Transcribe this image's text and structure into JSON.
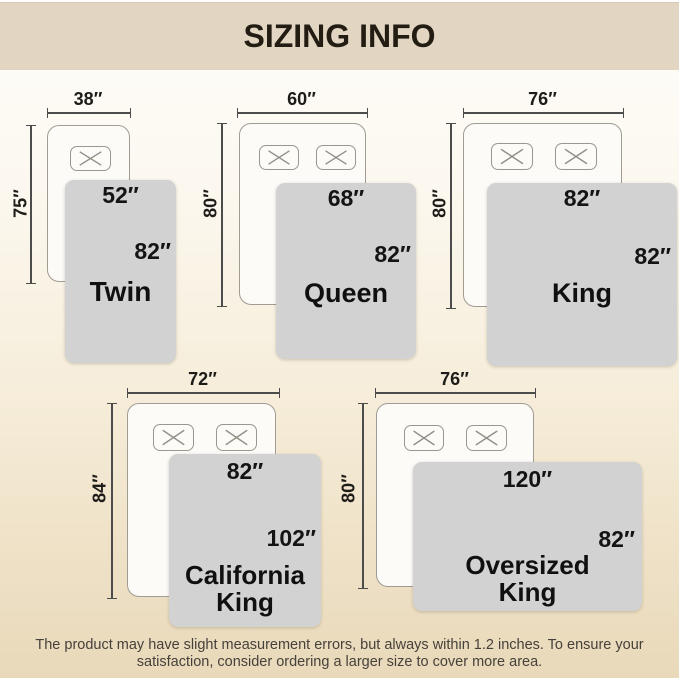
{
  "header": {
    "title": "SIZING INFO"
  },
  "colors": {
    "header_bg": "#e2d6c3",
    "page_gradient_top": "#fefdfb",
    "page_gradient_bottom": "#e9d9ba",
    "blanket_fill": "#d2d2d2",
    "bed_fill": "#fcfbf8",
    "line_color": "#4c4c4c",
    "text_dark": "#141414"
  },
  "diagrams": [
    {
      "name": "Twin",
      "bed_width": "38″",
      "bed_length": "75″",
      "quilt_width": "52″",
      "quilt_length": "82″",
      "pillows": 1
    },
    {
      "name": "Queen",
      "bed_width": "60″",
      "bed_length": "80″",
      "quilt_width": "68″",
      "quilt_length": "82″",
      "pillows": 2
    },
    {
      "name": "King",
      "bed_width": "76″",
      "bed_length": "80″",
      "quilt_width": "82″",
      "quilt_length": "82″",
      "pillows": 2
    },
    {
      "name": "California King",
      "bed_width": "72″",
      "bed_length": "84″",
      "quilt_width": "82″",
      "quilt_length": "102″",
      "pillows": 2
    },
    {
      "name": "Oversized King",
      "bed_width": "76″",
      "bed_length": "80″",
      "quilt_width": "120″",
      "quilt_length": "82″",
      "pillows": 2
    }
  ],
  "footer": {
    "line1": "The product may have slight measurement errors, but always within 1.2 inches. To ensure your",
    "line2": "satisfaction, consider ordering a larger size to cover more area."
  }
}
